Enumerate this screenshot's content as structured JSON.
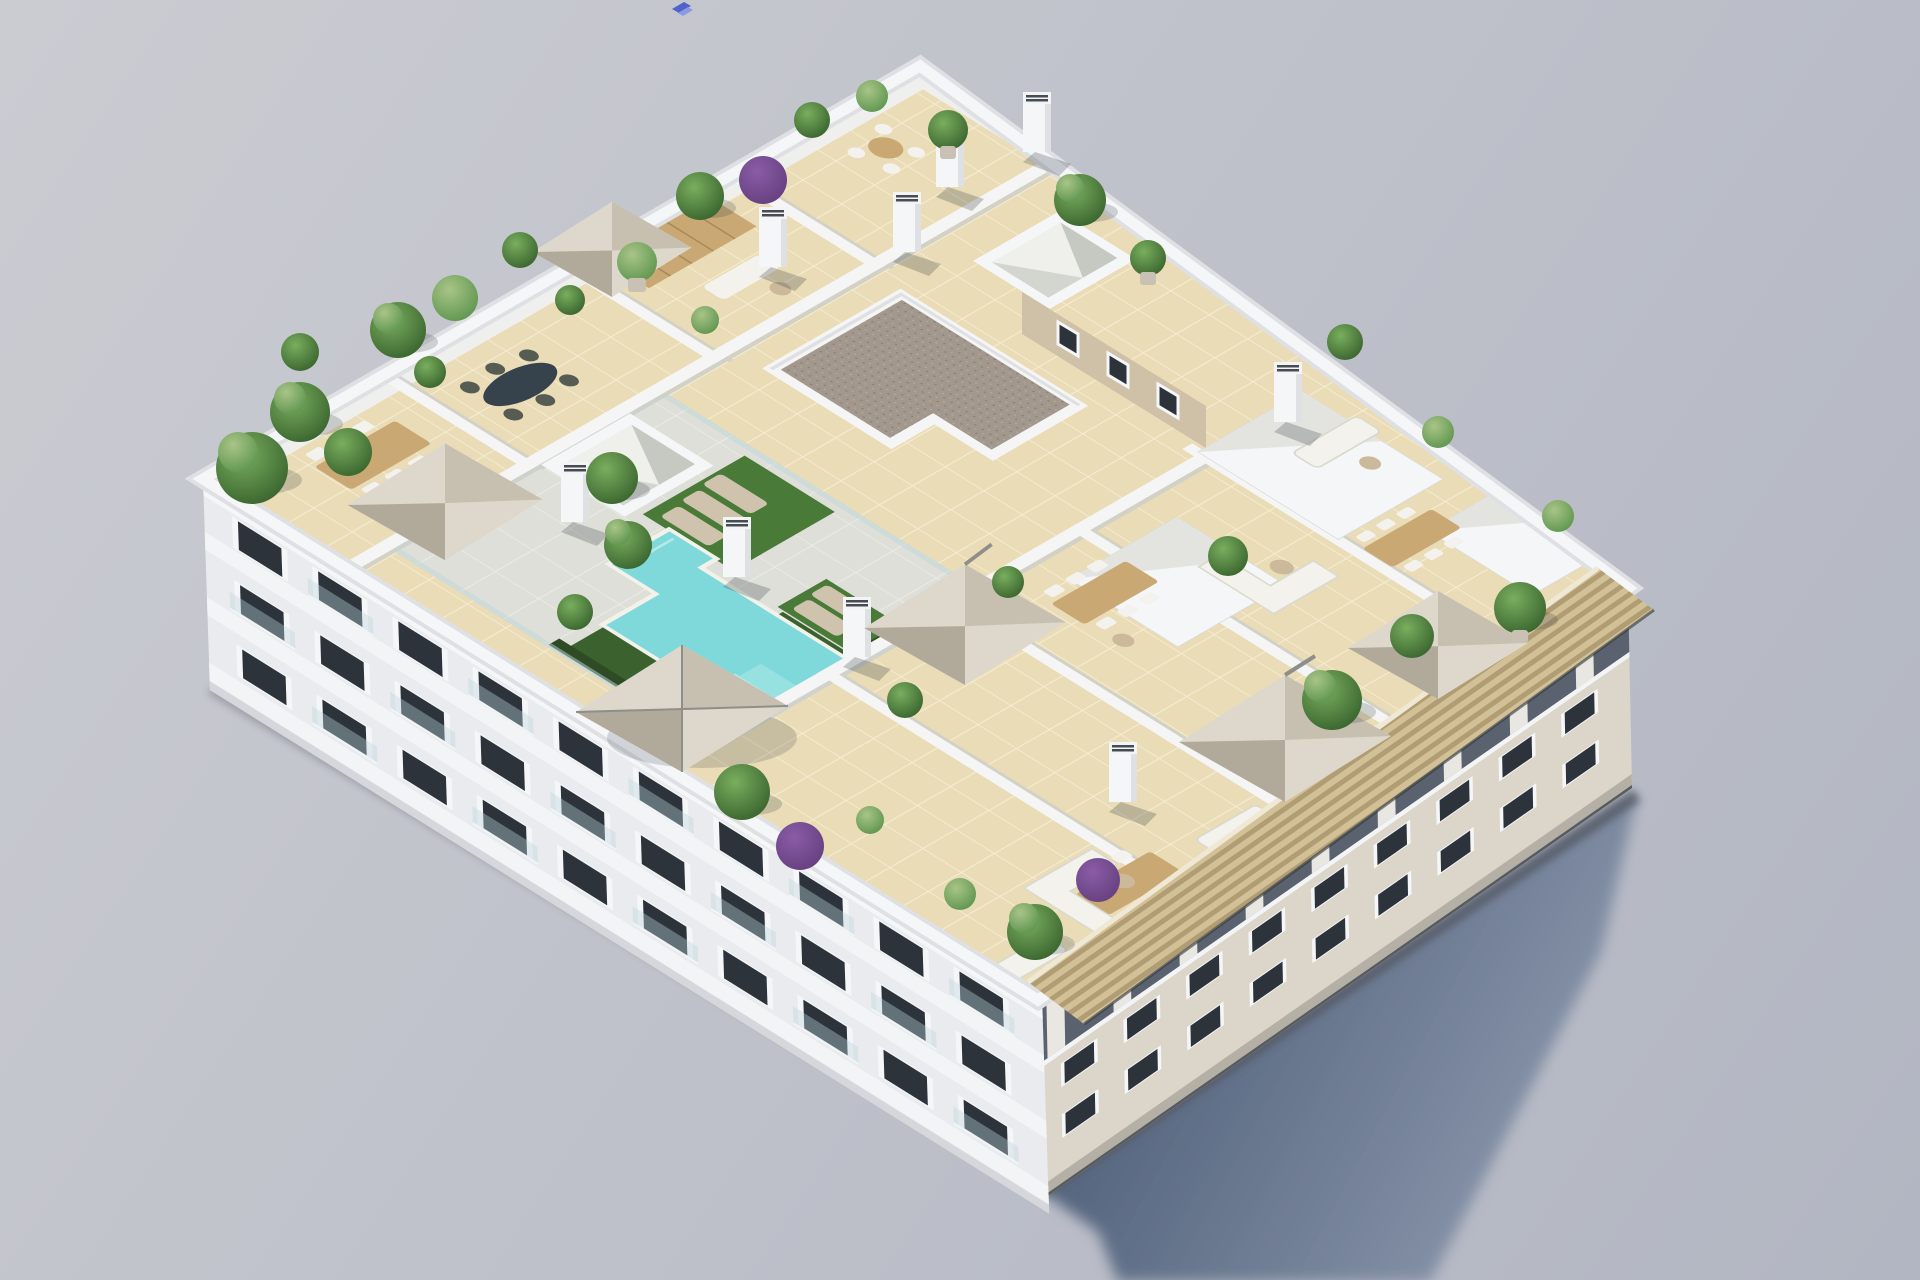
{
  "meta": {
    "description": "Aerial axonometric 3D render of a white 4-storey apartment block with a communal rooftop: turquoise L-shaped pool, artificial turf with sun loungers, private tiled terraces divided by white walls, parasols, dining sets, white sofas, many potted palms and bougainvillea, two pyramid skylights, stair bulkheads, a brown gravel core roof, and a clay-slat canopy over the right facade. Soft blue-grey shadow cast to the lower right on a plain grey backdrop.",
    "type": "3d-architectural-render",
    "visible_text": ""
  },
  "colors": {
    "bgTop": "#cbccd2",
    "bgBottom": "#b2b6c2",
    "shadowNear": "#56667f",
    "shadowFar": "#8d99ae",
    "aoDark": "#2f3640",
    "buildingWhite": "#f5f6f8",
    "parapetEdge": "#dfe0e3",
    "parapetInner": "#eff0ed",
    "facadeLeft": "#e9ebee",
    "facadeSlab": "#f3f4f6",
    "facadeBase": "#d5d7db",
    "windowGlass": "#2c333b",
    "windowFrame": "#f5f6f8",
    "railGlass": "#bcd8dc",
    "facadeRight": "#dcd5c9",
    "facadeRightBase": "#b5b0a6",
    "recessDark": "#59626e",
    "columnLight": "#e9e7e2",
    "canopyBase": "#d2c096",
    "canopySlat": "#b19d74",
    "canopyFascia": "#efe8d4",
    "tile": "#e9dcb6",
    "tileLine": "#f5ecd2",
    "deck": "#dedfd8",
    "deckLine": "#ebecE8",
    "wallWhite": "#f4f5f4",
    "wallShade": "#cdcfc9",
    "gravel": "#a3988d",
    "gravelDot": "#8a8075",
    "coreBeige": "#cfc0a8",
    "poolDeep": "#3fbdc4",
    "poolLight": "#7fd9da",
    "poolStep": "#ace8e6",
    "poolEdge": "#f2f2ea",
    "grass": "#3a612e",
    "turf": "#4a7a38",
    "hedge": "#2e4b26",
    "wood": "#c9a873",
    "woodDark": "#a8875c",
    "tableDark": "#36424c",
    "chairWhite": "#f4f2ee",
    "chairDark": "#565b54",
    "sofaWhite": "#f3f2ed",
    "sofaLine": "#d9d9cd",
    "lounger": "#cfc3ad",
    "umbTop": "#ded8cc",
    "umbShade": "#c7c0b1",
    "umbDark": "#b1a999",
    "pole": "#8e8e8a",
    "plantDark": "#2c5424",
    "plantMid": "#4e8c42",
    "plantLight": "#79ae5e",
    "plantPale": "#a9c488",
    "purple": "#8a5ca6",
    "purpleDark": "#5e3a77",
    "potTan": "#c9c2b4",
    "chimneyVent": "#474c52",
    "stoneTable": "#cbb99a",
    "artifactBlue1": "#4f63c8",
    "artifactBlue2": "#8b9ae0"
  },
  "scene": {
    "ground": "plain light grey backdrop with soft diagonal gradient",
    "shadow": "large soft blue-grey building shadow cast toward lower right",
    "building": {
      "storeys_visible": 4,
      "left_facade": "white banded facade, recessed balconies with dark glazing and glass rails",
      "right_facade": "warm light stone wall, punched dark windows, recessed top-floor balconies under a clay slat canopy"
    },
    "rooftop": {
      "pool": "turquoise L/Z-shaped pool with pale entry steps and glass safety fence",
      "turf_areas": 4,
      "sun_loungers": 5,
      "parasols": 6,
      "dining_sets": 6,
      "sofa_sets": 5,
      "skylight_pyramids": 2,
      "stair_bulkheads": 3,
      "chimneys": 9,
      "core_roof": "brown gravel L-shaped roof over beige stair core with 3 small windows",
      "planting": "palms, box shrubs, olive trees, purple bougainvillea in pots along parapets"
    },
    "artifact_note": "tiny blue chevron artifact floating near top edge of frame"
  }
}
